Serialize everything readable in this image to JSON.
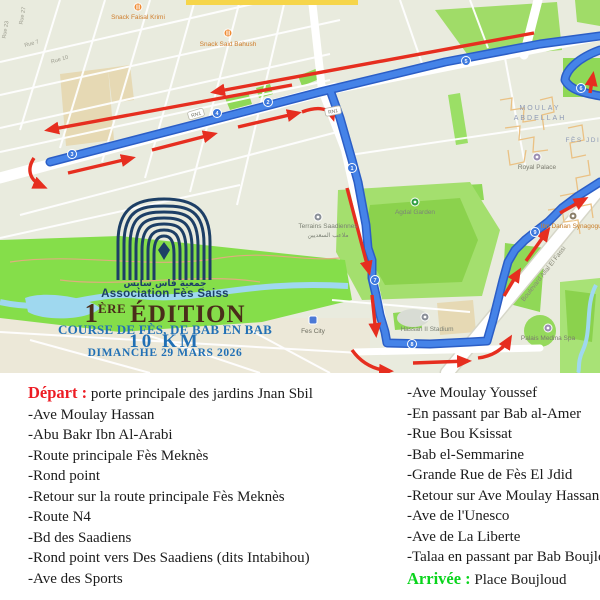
{
  "event": {
    "association_arabic": "جمعية فاس سايس",
    "association_name": "Association Fès Saiss",
    "edition_num": "1",
    "edition_sup": "ÈRE",
    "edition_word": "ÉDITION",
    "race_name": "COURSE DE FÈS, DE BAB EN BAB",
    "distance": "10 KM",
    "date": "DIMANCHE 29 MARS 2026"
  },
  "route_description": {
    "depart_label": "Départ :",
    "depart_value": " porte principale des jardins Jnan Sbil",
    "left_items": [
      "-Ave Moulay Hassan",
      "-Abu Bakr Ibn Al-Arabi",
      "-Route principale Fès Meknès",
      "-Rond point",
      "-Retour sur la route principale Fès Meknès",
      "-Route N4",
      "-Bd des Saadiens",
      "-Rond point vers Des Saadiens (dits Intabihou)",
      "-Ave des Sports"
    ],
    "right_items": [
      "-Ave Moulay Youssef",
      "-En passant par Bab al-Amer",
      "-Rue Bou Ksissat",
      "-Bab el-Semmarine",
      "-Grande Rue de Fès El Jdid",
      "-Retour sur Ave Moulay Hassan",
      "-Ave de l'Unesco",
      "-Ave de La Liberte",
      "-Talaa en passant par Bab Boujloud"
    ],
    "arrivee_label": "Arrivée :",
    "arrivee_value": " Place Boujloud"
  },
  "map": {
    "road_shield": "RN1",
    "km_markers": [
      "1",
      "2",
      "3",
      "4",
      "5",
      "6",
      "7",
      "8",
      "9"
    ],
    "labels": {
      "snack1": "Snack Faisal Krimi",
      "snack2": "Snack Said Bahush",
      "rue27": "Rue 27",
      "rue23": "Rue 23",
      "rue7": "Rue 7",
      "rue10": "Rue 10",
      "moulay1": "MOULAY",
      "moulay2": "ABDELLAH",
      "fes_jdid": "FÈS JDID",
      "royal_palace": "Royal Palace",
      "agdal": "Agdal Garden",
      "terrains": "Terrains Saadiennes",
      "terrains_ar": "ملاعب السعديين",
      "stadium": "Hassan II Stadium",
      "fes_city": "Fes City",
      "ibn_danan": "Ibn Danan Synagogue",
      "blvd_allal": "Boulevard Allal El Fassi",
      "palais": "Palais Medina Spa"
    }
  },
  "colors": {
    "route_blue": "#4583e8",
    "arrow_red": "#e62e1f",
    "depart_red": "#ed1c24",
    "arrivee_green": "#09d41c",
    "title_blue": "#2170b5",
    "title_brown": "#4a2d1a",
    "logo_navy": "#1d3f66"
  }
}
